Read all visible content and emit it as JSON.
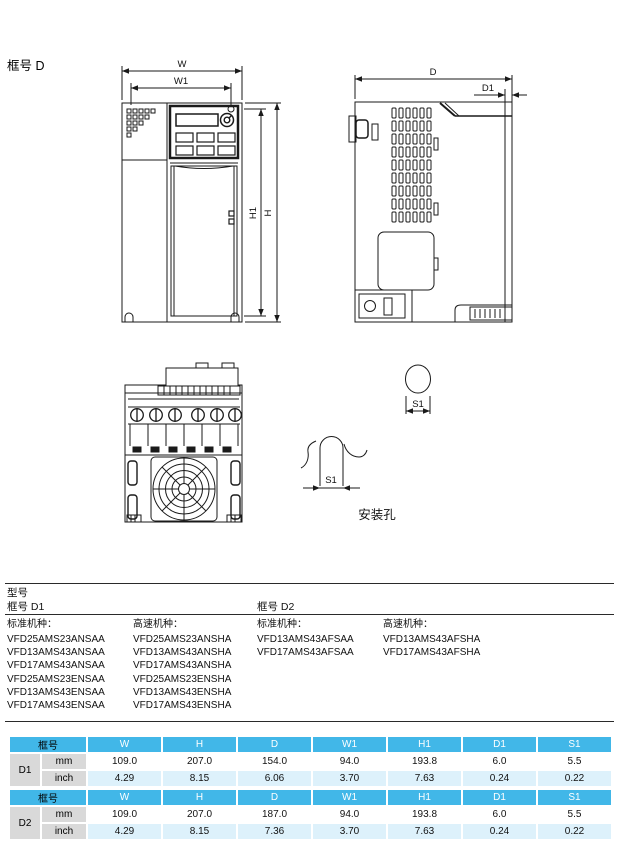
{
  "page": {
    "title": "框号 D"
  },
  "drawing": {
    "labels": {
      "w": "W",
      "w1": "W1",
      "h": "H",
      "h1": "H1",
      "d": "D",
      "d1": "D1",
      "s1_circle": "S1",
      "s1_slot": "S1"
    },
    "caption_mounting_hole": "安装孔"
  },
  "models": {
    "section_title": "型号",
    "groups": [
      {
        "frame_label": "框号 D1",
        "standard_title": "标准机种：",
        "standard_models": [
          "VFD25AMS23ANSAA",
          "VFD13AMS43ANSAA",
          "VFD17AMS43ANSAA",
          "VFD25AMS23ENSAA",
          "VFD13AMS43ENSAA",
          "VFD17AMS43ENSAA"
        ],
        "highspeed_title": "高速机种：",
        "highspeed_models": [
          "VFD25AMS23ANSHA",
          "VFD13AMS43ANSHA",
          "VFD17AMS43ANSHA",
          "VFD25AMS23ENSHA",
          "VFD13AMS43ENSHA",
          "VFD17AMS43ENSHA"
        ]
      },
      {
        "frame_label": "框号 D2",
        "standard_title": "标准机种：",
        "standard_models": [
          "VFD13AMS43AFSAA",
          "VFD17AMS43AFSAA"
        ],
        "highspeed_title": "高速机种：",
        "highspeed_models": [
          "VFD13AMS43AFSHA",
          "VFD17AMS43AFSHA"
        ]
      }
    ]
  },
  "dimension_tables": [
    {
      "headers": [
        "框号",
        "W",
        "H",
        "D",
        "W1",
        "H1",
        "D1",
        "S1"
      ],
      "frame": "D1",
      "rows": [
        {
          "unit": "mm",
          "values": [
            "109.0",
            "207.0",
            "154.0",
            "94.0",
            "193.8",
            "6.0",
            "5.5"
          ]
        },
        {
          "unit": "inch",
          "values": [
            "4.29",
            "8.15",
            "6.06",
            "3.70",
            "7.63",
            "0.24",
            "0.22"
          ]
        }
      ]
    },
    {
      "headers": [
        "框号",
        "W",
        "H",
        "D",
        "W1",
        "H1",
        "D1",
        "S1"
      ],
      "frame": "D2",
      "rows": [
        {
          "unit": "mm",
          "values": [
            "109.0",
            "207.0",
            "187.0",
            "94.0",
            "193.8",
            "6.0",
            "5.5"
          ]
        },
        {
          "unit": "inch",
          "values": [
            "4.29",
            "8.15",
            "7.36",
            "3.70",
            "7.63",
            "0.24",
            "0.22"
          ]
        }
      ]
    }
  ],
  "colors": {
    "table_header_bg": "#41b7e8",
    "table_alt_row_bg": "#ddf1fb",
    "table_label_bg": "#d9d9d9",
    "line_color": "#1a1a1a"
  }
}
